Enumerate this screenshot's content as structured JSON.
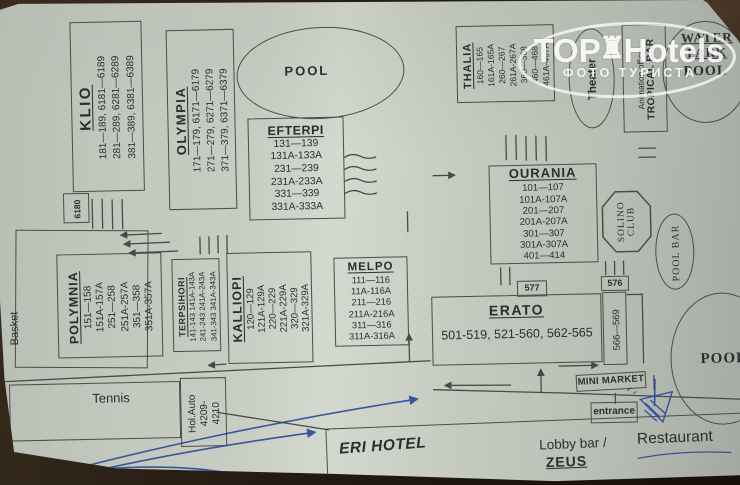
{
  "watermark": {
    "top": "TOP",
    "hotels": "Hotels",
    "crown_glyph": "♜",
    "subtitle": "ФОТО ТУРИСТА"
  },
  "facilities": {
    "pool_top": "POOL",
    "pool_ne": "POOL",
    "pool_se": "POOL",
    "water_park_line1": "WATER",
    "water_park_line2": "PARK",
    "theater": "Theater",
    "animation_office": "Animation office",
    "tropical_bar": "TROPICAL BAR",
    "solino_line1": "SOLINO",
    "solino_line2": "CLUB",
    "pool_bar": "POOL BAR",
    "basket": "Basket",
    "tennis": "Tennis",
    "mini_market": "MINI MARKET",
    "entrance": "entrance"
  },
  "labels": {
    "b6180": "6180",
    "b577": "577",
    "b576": "576",
    "b566_569": "566—569",
    "hol_auto": [
      "Hol.Auto",
      "4209-",
      "4210"
    ]
  },
  "hotel": {
    "name": "ERI HOTEL",
    "lobby": "Lobby bar /",
    "zeus": "ZEUS",
    "restaurant": "Restaurant"
  },
  "buildings": {
    "klio": {
      "name": "KLIO",
      "lines": [
        "181—189, 6181—6189",
        "281—289, 6281—6289",
        "381—389, 6381—6389"
      ]
    },
    "olympia": {
      "name": "OLYMPIA",
      "lines": [
        "171—179, 6171—6179",
        "271—279, 6271—6279",
        "371—379, 6371—6379"
      ]
    },
    "efterpi": {
      "name": "EFTERPI",
      "lines": [
        "131—139",
        "131A-133A",
        "231—239",
        "231A-233A",
        "331—339",
        "331A-333A"
      ]
    },
    "thalia": {
      "name": "THALIA",
      "lines": [
        "160—165",
        "161A-165A",
        "260—267",
        "261A-267A",
        "360—368",
        "460—468",
        "461A-467A"
      ]
    },
    "ourania": {
      "name": "OURANIA",
      "lines": [
        "101—107",
        "101A-107A",
        "201—207",
        "201A-207A",
        "301—307",
        "301A-307A",
        "401—414"
      ]
    },
    "melpo": {
      "name": "MELPO",
      "lines": [
        "111—116",
        "11A-116A",
        "211—216",
        "211A-216A",
        "311—316",
        "311A-316A"
      ]
    },
    "kalliopi": {
      "name": "KALLIOPI",
      "lines": [
        "120—129",
        "121A-129A",
        "220—229",
        "221A-229A",
        "320—329",
        "321A-329A"
      ]
    },
    "terpsihori": {
      "name": "TERPSIHORI",
      "lines": [
        "141-143 141A-143A",
        "241-243 241A-243A",
        "341-343 341A-343A"
      ]
    },
    "polymnia": {
      "name": "POLYMNIA",
      "lines": [
        "151—158",
        "151A-157A",
        "251—258",
        "251A-257A",
        "351—358",
        "351A-357A"
      ]
    },
    "erato": {
      "name": "ERATO",
      "lines": [
        "501-519, 521-560, 562-565"
      ]
    }
  },
  "colors": {
    "ink": "#4a4e45",
    "pen_blue": "#2b479b",
    "paper": "#c7cdc3",
    "table": "#241b12"
  }
}
